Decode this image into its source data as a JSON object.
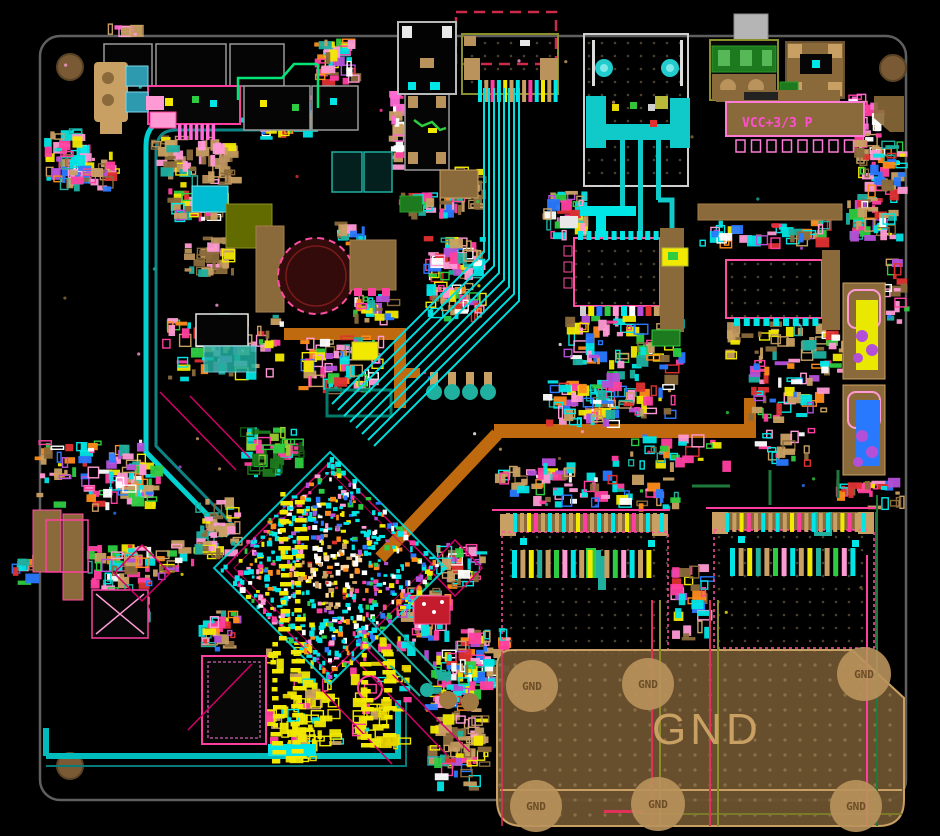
{
  "board": {
    "plane_label": "GND",
    "via_labels": [
      "GND",
      "GND",
      "GND",
      "GND",
      "GND",
      "GND"
    ],
    "net_label": "VCC+3/3 P",
    "colors": {
      "background": "#000000",
      "board_outline": "#5f5f5f",
      "copper_plane": "#6b5230",
      "plane_text": "#c9a063",
      "silkscreen_pink": "#ff3fa0",
      "trace_cyan": "#00e5e5",
      "trace_teal": "#1fb0a0",
      "trace_orange": "#c06a10",
      "pad_tan": "#c9a063",
      "pad_yellow": "#f2e900",
      "component_green": "#1e7a1e",
      "net_text_magenta": "#ff4fd0",
      "keepout_red": "#cc2a4a"
    }
  }
}
